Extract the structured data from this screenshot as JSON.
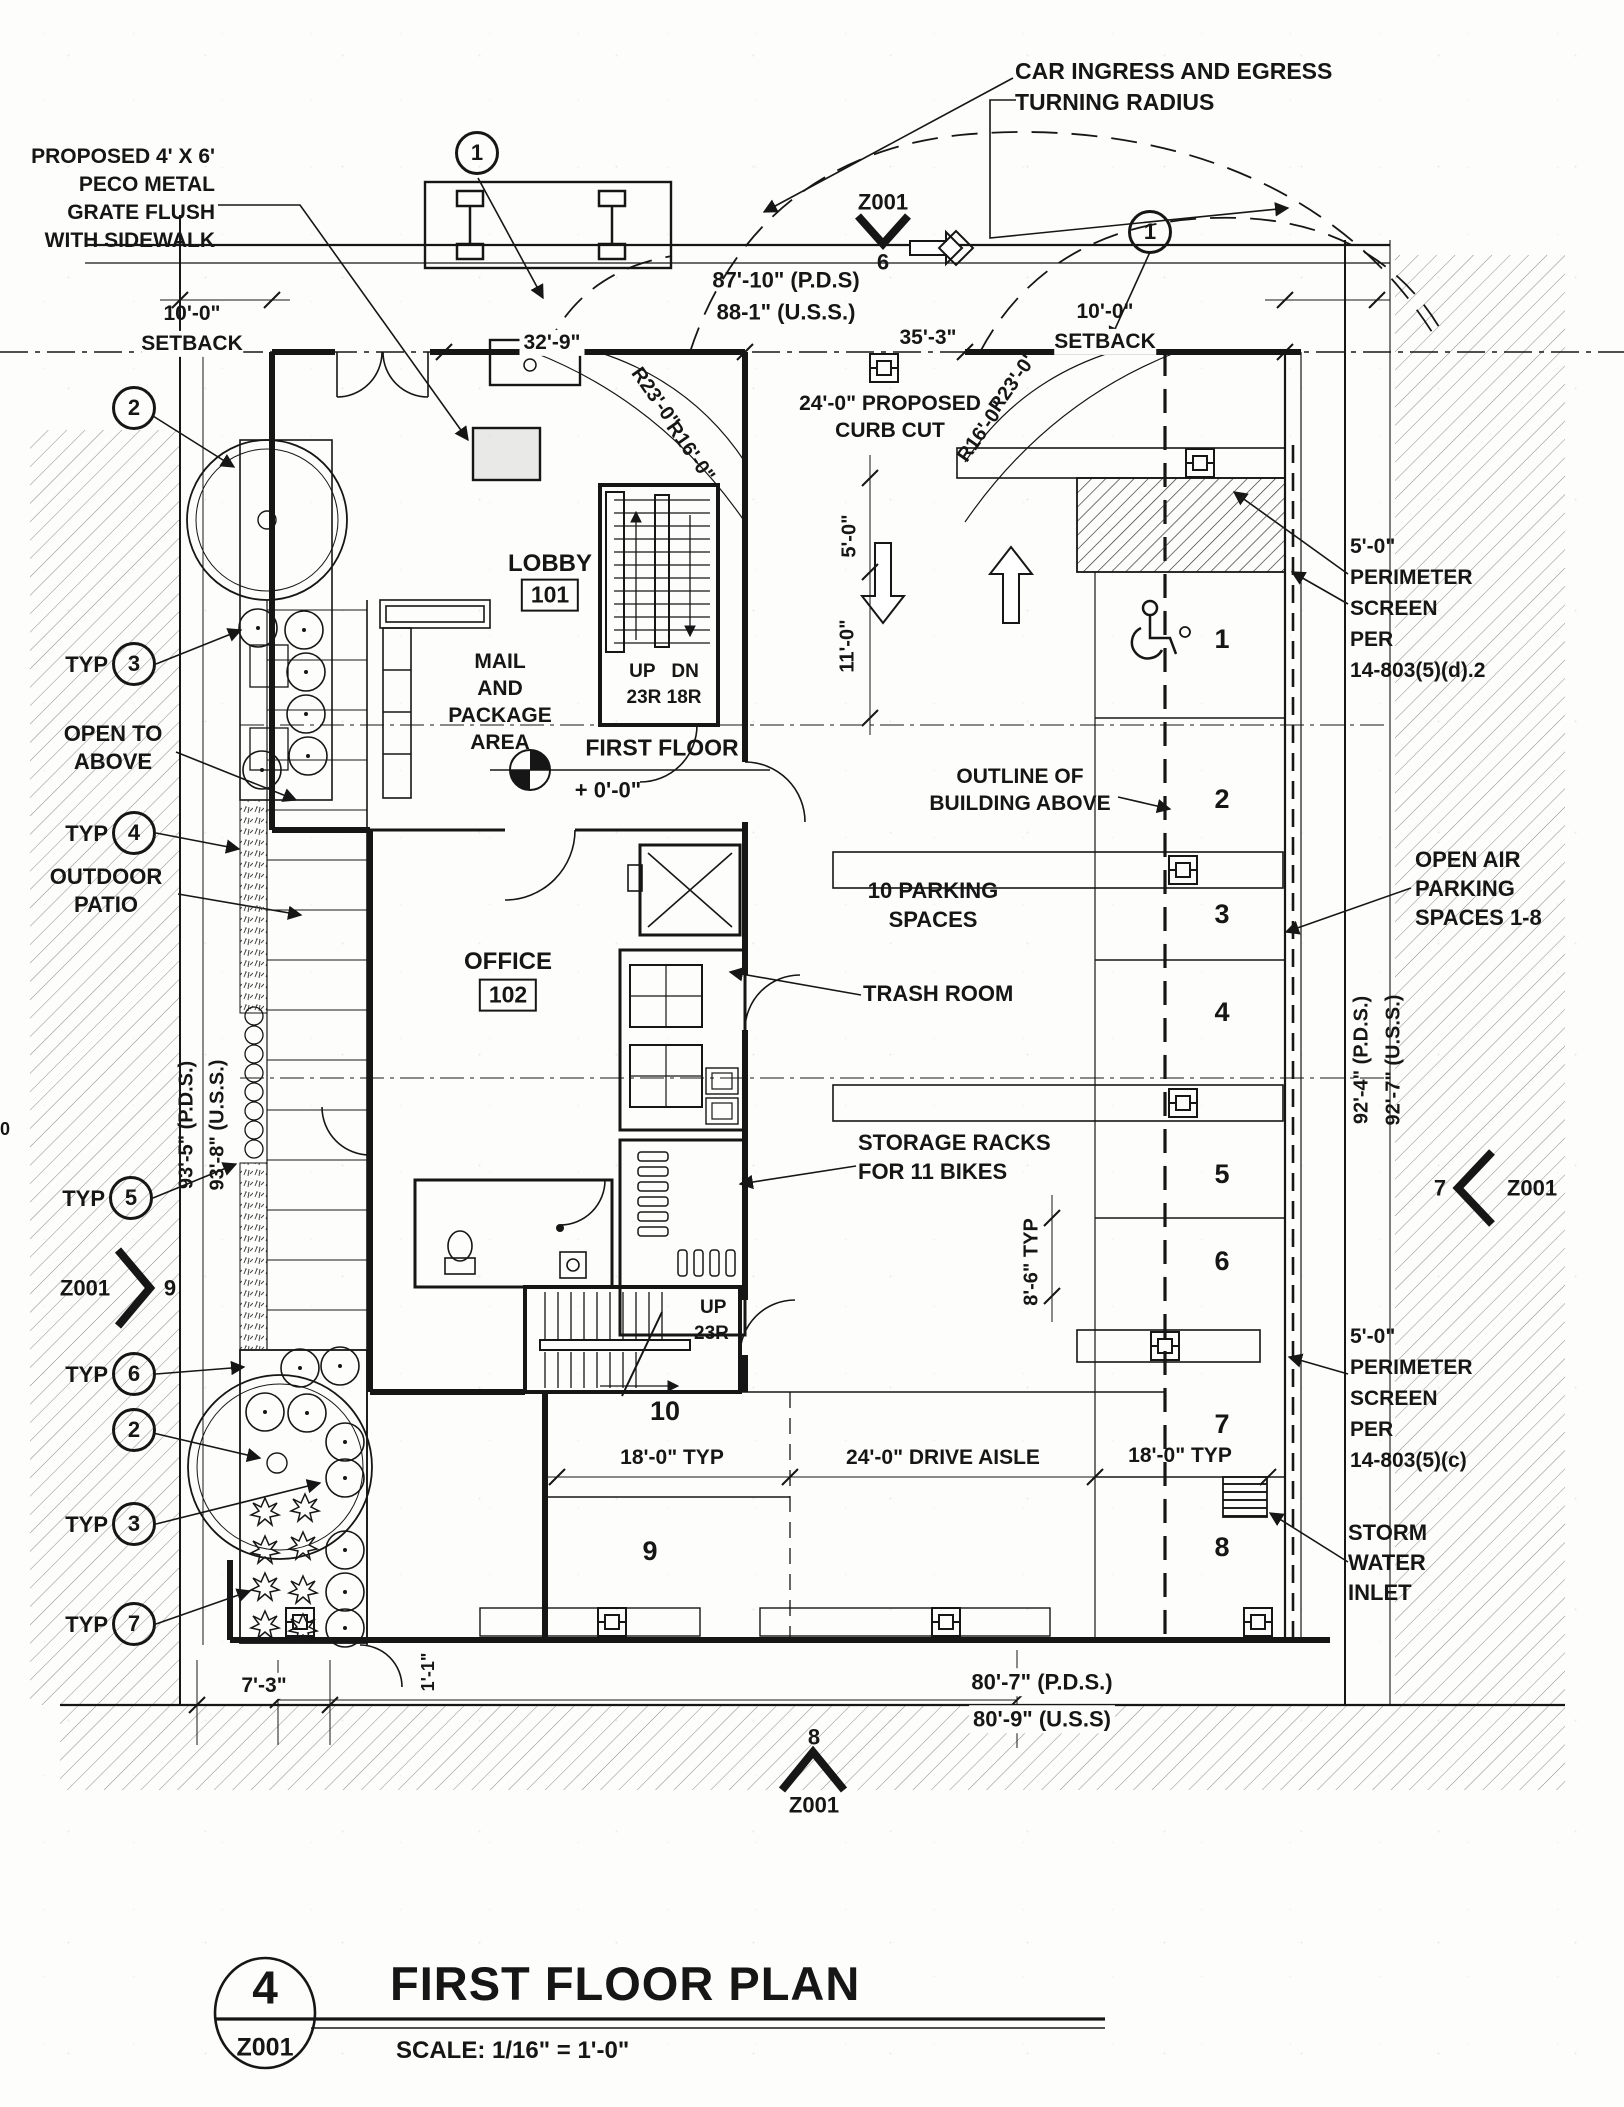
{
  "title_block": {
    "detail_number": "4",
    "sheet_ref": "Z001",
    "title": "FIRST FLOOR PLAN",
    "scale": "SCALE: 1/16\" = 1'-0\""
  },
  "callouts": {
    "peco_grate": "PROPOSED 4' X 6'\nPECO METAL\nGRATE FLUSH\nWITH SIDEWALK",
    "car_ingress": "CAR INGRESS AND EGRESS\nTURNING RADIUS",
    "curb_cut": "24'-0\" PROPOSED\nCURB CUT",
    "outline_above": "OUTLINE OF\nBUILDING ABOVE",
    "ten_parking": "10 PARKING\nSPACES",
    "trash_room": "TRASH ROOM",
    "storage_racks": "STORAGE RACKS\nFOR 11 BIKES",
    "open_to_above": "OPEN TO\nABOVE",
    "outdoor_patio": "OUTDOOR\nPATIO",
    "open_air": "OPEN AIR\nPARKING\nSPACES 1-8",
    "perimeter_screen_d2": "5'-0\"\nPERIMETER\nSCREEN\nPER\n14-803(5)(d).2",
    "perimeter_screen_c": "5'-0\"\nPERIMETER\nSCREEN\nPER\n14-803(5)(c)",
    "storm_water": "STORM\nWATER\nINLET",
    "edge_artifact": "0"
  },
  "rooms": {
    "lobby": {
      "name": "LOBBY",
      "number": "101"
    },
    "office": {
      "name": "OFFICE",
      "number": "102"
    },
    "mail": "MAIL\nAND\nPACKAGE\nAREA",
    "first_floor": {
      "label": "FIRST FLOOR",
      "elevation": "+ 0'-0\""
    },
    "stair1": {
      "updn": "UP   DN",
      "risers": "23R 18R"
    },
    "stair2": {
      "up": "UP",
      "risers": "23R"
    }
  },
  "dims": {
    "setback_val": "10'-0\"",
    "setback_word": "SETBACK",
    "d32_9": "32'-9\"",
    "d87_10": "87'-10\" (P.D.S)",
    "d88_1": "88-1\" (U.S.S.)",
    "d35_3": "35'-3\"",
    "r23": "R23'-0\"",
    "r16": "R16'-0\"",
    "d5_0": "5'-0\"",
    "d11_0": "11'-0\"",
    "d93_5": "93'-5\" (P.D.S.)",
    "d93_8": "93'-8\" (U.S.S.)",
    "d92_4": "92'-4\" (P.D.S.)",
    "d92_7": "92'-7\" (U.S.S.)",
    "d8_6": "8'-6\" TYP",
    "d18_typ": "18'-0\" TYP",
    "d24_aisle": "24'-0\" DRIVE AISLE",
    "d7_3": "7'-3\"",
    "d1_1": "1'-1\"",
    "d80_7": "80'-7\" (P.D.S.)",
    "d80_9": "80'-9\" (U.S.S)"
  },
  "markers": {
    "sheet": "Z001",
    "n6": "6",
    "n7": "7",
    "n8": "8",
    "n9": "9",
    "c1": "1",
    "c2": "2",
    "typ": "TYP",
    "t3": "3",
    "t4": "4",
    "t5": "5",
    "t6": "6",
    "t7": "7"
  },
  "parking": {
    "spaces": [
      "1",
      "2",
      "3",
      "4",
      "5",
      "6",
      "7",
      "8",
      "9",
      "10"
    ]
  }
}
